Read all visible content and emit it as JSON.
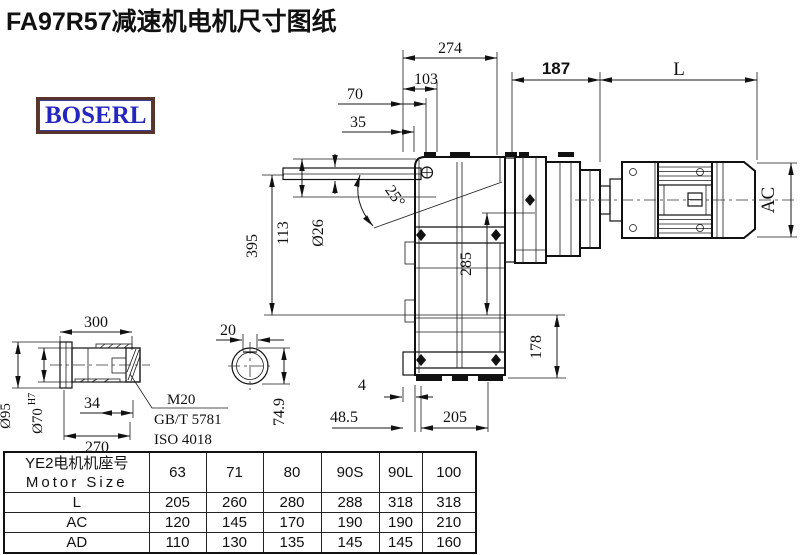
{
  "page": {
    "title": "FA97R57减速机电机尺寸图纸",
    "logo": "BOSERL"
  },
  "drawing": {
    "dims": {
      "d274": "274",
      "d103": "103",
      "d70": "70",
      "d35": "35",
      "d187": "187",
      "dL": "L",
      "dAC": "AC",
      "d395": "395",
      "d113": "113",
      "d26": "Ø26",
      "d25": "25°",
      "d285": "285",
      "d178": "178",
      "d4": "4",
      "d48": "48.5",
      "d205": "205",
      "d300": "300",
      "d95": "Ø95",
      "d70s": "Ø70",
      "d70t": "H7",
      "d34": "34",
      "d270": "270",
      "m20": "M20",
      "gbt": "GB/T 5781",
      "iso": "ISO 4018",
      "d20": "20",
      "d749": "74.9"
    }
  },
  "table": {
    "header_cn": "YE2电机机座号",
    "header_en": "Motor Size",
    "sizes": [
      "63",
      "71",
      "80",
      "90S",
      "90L",
      "100"
    ],
    "rows": [
      {
        "label": "L",
        "values": [
          "205",
          "260",
          "280",
          "288",
          "318",
          "318"
        ]
      },
      {
        "label": "AC",
        "values": [
          "120",
          "145",
          "170",
          "190",
          "190",
          "210"
        ]
      },
      {
        "label": "AD",
        "values": [
          "110",
          "130",
          "135",
          "145",
          "145",
          "160"
        ]
      }
    ]
  }
}
